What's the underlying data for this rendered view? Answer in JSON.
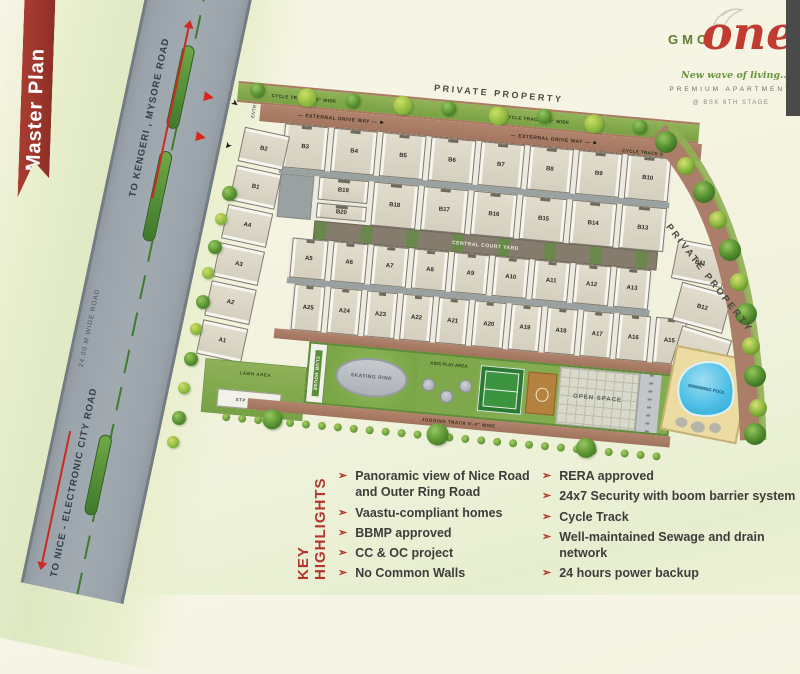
{
  "icons": {
    "bullet": "➢",
    "arrow_right": "►",
    "gate_arrow": "➤"
  },
  "ribbon": {
    "label": "Master Plan"
  },
  "logo": {
    "brand": "GMC",
    "brand2": "one",
    "tagline": "New wave of living...",
    "subtitle": "PREMIUM APARTMENT",
    "stage": "@ BSK 6TH STAGE"
  },
  "road": {
    "to_top": "TO KENGERI , MYSORE ROAD",
    "width_label": "24.00 M WIDE ROAD",
    "to_bottom": "TO NICE - ELECTRONIC CITY ROAD"
  },
  "site": {
    "private_property_top": "PRIVATE PROPERTY",
    "private_property_right": "PRIVATE PROPERTY",
    "cycle_track_label": "CYCLE TRACK 8'-0\" WIDE",
    "external_drive_way": "EXTERNAL DRIVE WAY",
    "central_courtyard": "CENTRAL COURT YARD",
    "jogging_track_label": "JOGGING TRACK 5'-0\" WIDE",
    "entry_gate": "ENTRY GATE",
    "exit_gate": "EXIT GATE",
    "plots": {
      "left_column": [
        "B2",
        "B1",
        "A4",
        "A3",
        "A2",
        "A1"
      ],
      "b_row_top": [
        "B3",
        "B4",
        "B5",
        "B6",
        "B7",
        "B8",
        "B9",
        "B10"
      ],
      "b_mid_first": "B19",
      "b_mid_sub": "B20",
      "b_row_mid": [
        "B18",
        "B17",
        "B16",
        "B15",
        "B14",
        "B13"
      ],
      "right_column": [
        "B11",
        "B12",
        "A14"
      ],
      "a_row_upper": [
        "A5",
        "A6",
        "A7",
        "A8",
        "A9",
        "A10",
        "A11",
        "A12",
        "A13"
      ],
      "a_row_lower": [
        "A25",
        "A24",
        "A23",
        "A22",
        "A21",
        "A20",
        "A19",
        "A18",
        "A17",
        "A16",
        "A15"
      ]
    },
    "amenities": {
      "lawn": "LAWN AREA",
      "stp": "STP AREA",
      "club": "CLUB HOUSE",
      "skating": "SKATING RINK",
      "kids": "KIDS PLAY AREA",
      "open": "OPEN SPACE",
      "pool": "SWIMMING POOL"
    }
  },
  "highlights": {
    "title": "KEY HIGHLIGHTS",
    "left": [
      "Panoramic view of Nice Road and Outer Ring Road",
      "Vaastu-compliant homes",
      "BBMP approved",
      "CC & OC project",
      "No Common Walls"
    ],
    "right": [
      "RERA approved",
      "24x7 Security with boom barrier system",
      "Cycle Track",
      "Well-maintained Sewage and drain network",
      "24 hours power backup"
    ]
  }
}
